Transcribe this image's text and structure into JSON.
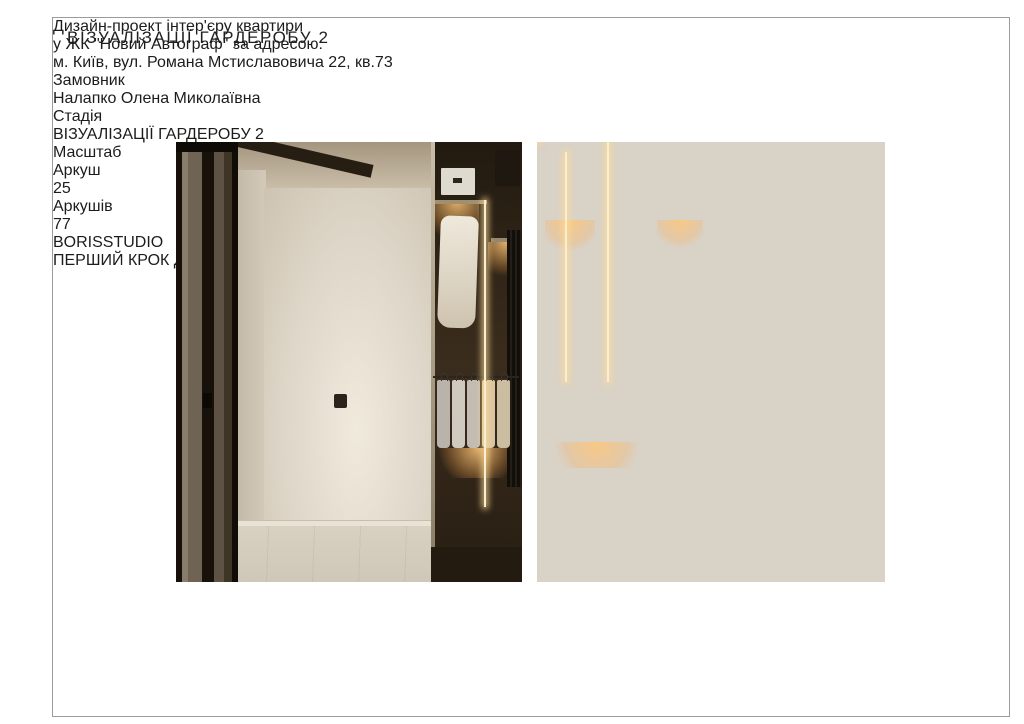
{
  "page": {
    "title": "ВІЗУАЛІЗАЦІЇ ГАРДЕРОБУ 2"
  },
  "renders": [
    {
      "label": "wardrobe-hallway-render"
    },
    {
      "label": "wardrobe-interior-render"
    }
  ],
  "title_block": {
    "project": {
      "line1": "Дизайн-проект інтер'єру квартири",
      "line2": "у ЖК \"Новий Автограф\" за адресою:",
      "line3": "м. Київ, вул. Романа Мстиславовича 22, кв.73"
    },
    "customer": {
      "header": "Замовник",
      "value": "Налапко Олена Миколаївна"
    },
    "stage": {
      "header": "Стадія",
      "value": "ВІЗУАЛІЗАЦІЇ ГАРДЕРОБУ 2"
    },
    "scale": {
      "header": "Масштаб",
      "value": ""
    },
    "sheet": {
      "header": "Аркуш",
      "value": "25"
    },
    "sheets": {
      "header": "Аркушів",
      "value": "77"
    },
    "logo": {
      "name": "BORISSTUDIO",
      "tagline": "ПЕРШИЙ КРОК ДО МРІЇ"
    }
  },
  "colors": {
    "accent_warm_light": "#ffc678",
    "wood_dark": "#3b2d1d",
    "wall_beige": "#ded6c8",
    "frame_greige": "#9c8e7b",
    "logo_black": "#000000"
  }
}
